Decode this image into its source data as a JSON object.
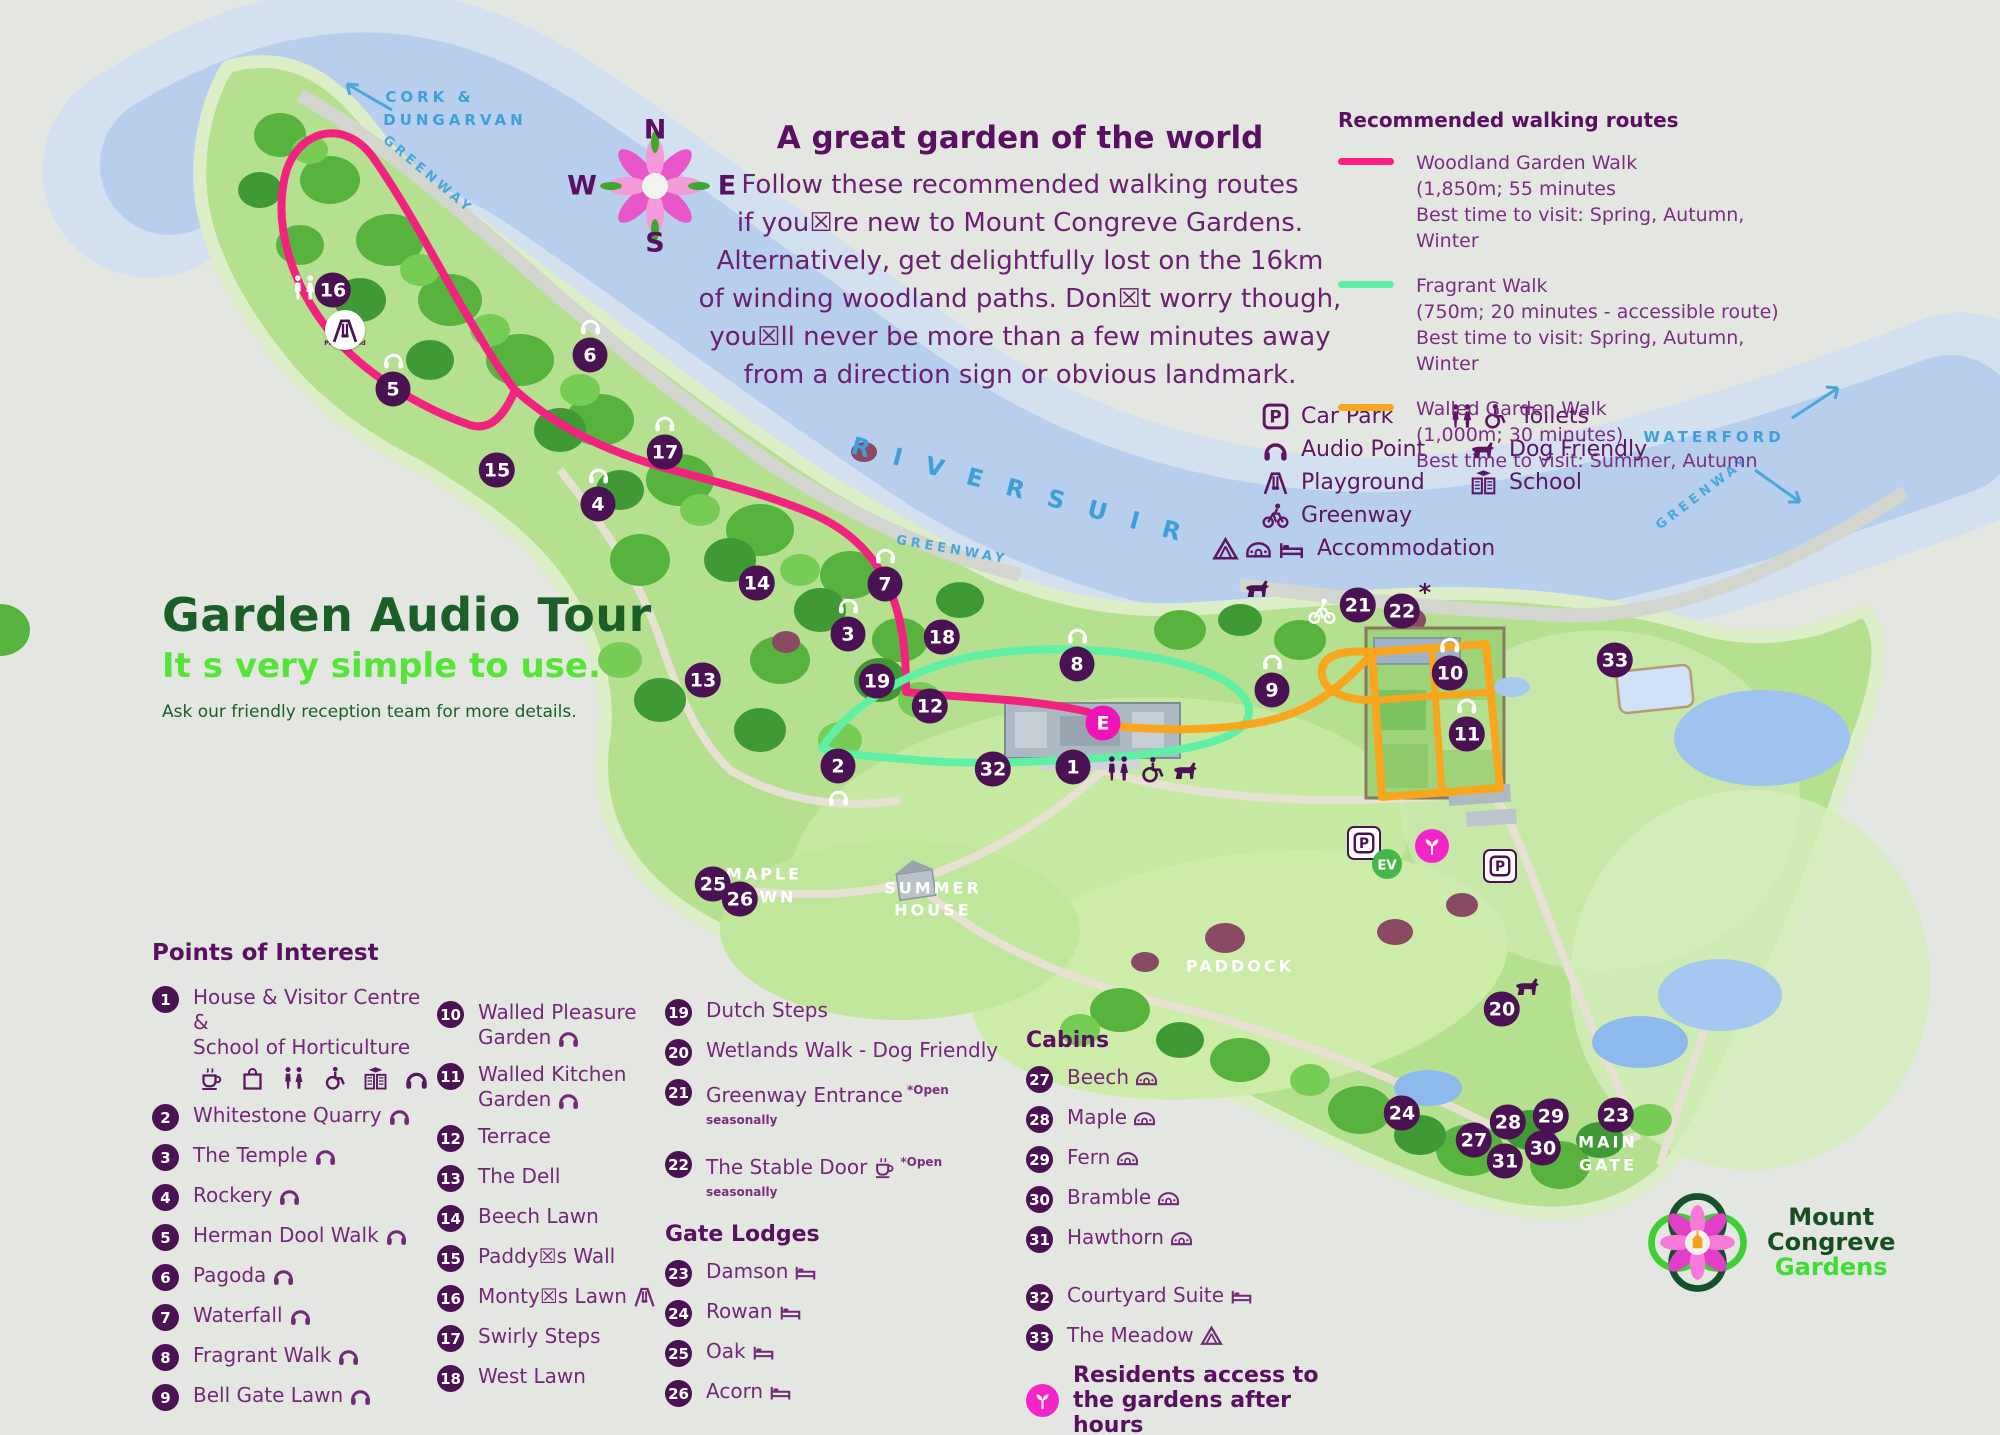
{
  "intro": {
    "title": "A great garden of the world",
    "lines": [
      "Follow these recommended walking routes",
      "if you☒re new to Mount Congreve Gardens.",
      "Alternatively, get delightfully lost on the 16km",
      "of winding woodland paths. Don☒t worry though,",
      "you☒ll never be more than a few minutes away",
      "from a direction sign or obvious landmark."
    ]
  },
  "routes": {
    "heading": "Recommended walking routes",
    "items": [
      {
        "name": "Woodland Garden Walk",
        "detail": "(1,850m; 55 minutes",
        "best": "Best time to visit: Spring, Autumn, Winter",
        "color": "#ff1f7e"
      },
      {
        "name": "Fragrant Walk",
        "detail": "(750m; 20 minutes - accessible route)",
        "best": "Best time to visit: Spring, Autumn, Winter",
        "color": "#5df0a5"
      },
      {
        "name": "Walled Garden Walk",
        "detail": "(1,000m; 30 minutes)",
        "best": "Best time to visit: Summer, Autumn",
        "color": "#f9a61f"
      }
    ]
  },
  "legend": {
    "left": [
      {
        "icon": "carpark",
        "label": "Car Park"
      },
      {
        "icon": "headphones",
        "label": "Audio Point"
      },
      {
        "icon": "playground",
        "label": "Playground"
      },
      {
        "icon": "bike",
        "label": "Greenway"
      },
      {
        "icon": "accommodation",
        "label": "Accommodation"
      }
    ],
    "right": [
      {
        "icon": "toilets",
        "label": "Toilets"
      },
      {
        "icon": "dog",
        "label": "Dog Friendly"
      },
      {
        "icon": "school",
        "label": "School"
      }
    ]
  },
  "audio_tour": {
    "title": "Garden Audio Tour",
    "subtitle": "It s very simple to use.",
    "note": "Ask our friendly reception team for more details."
  },
  "poi": {
    "heading": "Points of Interest",
    "item1": {
      "num": "1",
      "line1": "House & Visitor Centre &",
      "line2": "School of Horticulture"
    },
    "col1": [
      {
        "num": "2",
        "label": "Whitestone Quarry",
        "hp": true
      },
      {
        "num": "3",
        "label": "The Temple",
        "hp": true
      },
      {
        "num": "4",
        "label": "Rockery",
        "hp": true
      },
      {
        "num": "5",
        "label": "Herman Dool Walk",
        "hp": true
      },
      {
        "num": "6",
        "label": "Pagoda",
        "hp": true
      },
      {
        "num": "7",
        "label": "Waterfall",
        "hp": true
      },
      {
        "num": "8",
        "label": "Fragrant Walk",
        "hp": true
      },
      {
        "num": "9",
        "label": "Bell Gate Lawn",
        "hp": true
      }
    ],
    "col2": [
      {
        "num": "10",
        "label": "Walled Pleasure Garden",
        "hp": true
      },
      {
        "num": "11",
        "label": "Walled Kitchen Garden",
        "hp": true
      },
      {
        "num": "12",
        "label": "Terrace"
      },
      {
        "num": "13",
        "label": "The Dell"
      },
      {
        "num": "14",
        "label": "Beech Lawn"
      },
      {
        "num": "15",
        "label": "Paddy☒s Wall"
      },
      {
        "num": "16",
        "label": "Monty☒s Lawn",
        "pg": true
      },
      {
        "num": "17",
        "label": "Swirly Steps"
      },
      {
        "num": "18",
        "label": "West Lawn"
      }
    ],
    "col3": [
      {
        "num": "19",
        "label": "Dutch Steps"
      },
      {
        "num": "20",
        "label": "Wetlands Walk - Dog Friendly"
      },
      {
        "num": "21",
        "label": "Greenway Entrance",
        "open": "*Open seasonally"
      },
      {
        "num": "22",
        "label": "The Stable Door",
        "coffee": true,
        "open": "*Open seasonally"
      }
    ]
  },
  "gate_lodges": {
    "heading": "Gate Lodges",
    "items": [
      {
        "num": "23",
        "label": "Damson",
        "bed": true
      },
      {
        "num": "24",
        "label": "Rowan",
        "bed": true
      },
      {
        "num": "25",
        "label": "Oak",
        "bed": true
      },
      {
        "num": "26",
        "label": "Acorn",
        "bed": true
      }
    ]
  },
  "cabins": {
    "heading": "Cabins",
    "items": [
      {
        "num": "27",
        "label": "Beech",
        "pod": true
      },
      {
        "num": "28",
        "label": "Maple",
        "pod": true
      },
      {
        "num": "29",
        "label": "Fern",
        "pod": true
      },
      {
        "num": "30",
        "label": "Bramble",
        "pod": true
      },
      {
        "num": "31",
        "label": "Hawthorn",
        "pod": true
      }
    ],
    "extras": [
      {
        "num": "32",
        "label": "Courtyard Suite",
        "bed": true
      },
      {
        "num": "33",
        "label": "The Meadow",
        "tent": true
      }
    ]
  },
  "access_notes": {
    "residents": "Residents access to the gardens after hours",
    "exit_letter": "E",
    "exit": "Garden Exit"
  },
  "logo": {
    "line1": "Mount",
    "line2": "Congreve",
    "line3": "Gardens"
  },
  "map": {
    "labels": [
      {
        "text": "CORK &",
        "x": 430,
        "y": 97,
        "cls": "blue"
      },
      {
        "text": "DUNGARVAN",
        "x": 455,
        "y": 120,
        "cls": "blue"
      },
      {
        "text": "WATERFORD",
        "x": 1714,
        "y": 437,
        "cls": "blue"
      },
      {
        "text": "GREENWAY",
        "x": 428,
        "y": 175,
        "rot": 40,
        "cls": "blue-sm"
      },
      {
        "text": "GREENWAY",
        "x": 952,
        "y": 550,
        "rot": 10,
        "cls": "blue-sm"
      },
      {
        "text": "GREENWAY",
        "x": 1703,
        "y": 493,
        "rot": -37,
        "cls": "blue-sm"
      },
      {
        "text": "R I V E R   S U I R",
        "x": 1020,
        "y": 490,
        "rot": 15,
        "cls": "river",
        "size": 24,
        "ls": 8
      },
      {
        "text": "MAPLE",
        "x": 764,
        "y": 874,
        "cls": "white"
      },
      {
        "text": "LAWN",
        "x": 764,
        "y": 897,
        "cls": "white"
      },
      {
        "text": "SUMMER",
        "x": 933,
        "y": 888,
        "cls": "white"
      },
      {
        "text": "HOUSE",
        "x": 933,
        "y": 910,
        "cls": "white"
      },
      {
        "text": "PADDOCK",
        "x": 1240,
        "y": 966,
        "cls": "white"
      },
      {
        "text": "MAIN",
        "x": 1608,
        "y": 1142,
        "cls": "white"
      },
      {
        "text": "GATE",
        "x": 1608,
        "y": 1165,
        "cls": "white"
      },
      {
        "text": "Playground",
        "x": 345,
        "y": 343,
        "cls": "micro"
      },
      {
        "text": "N",
        "x": 655,
        "y": 130,
        "cls": "compass"
      },
      {
        "text": "W",
        "x": 582,
        "y": 186,
        "cls": "compass"
      },
      {
        "text": "E",
        "x": 727,
        "y": 186,
        "cls": "compass"
      },
      {
        "text": "S",
        "x": 655,
        "y": 243,
        "cls": "compass"
      }
    ],
    "markers": [
      {
        "num": "16",
        "x": 333,
        "y": 290
      },
      {
        "num": "5",
        "x": 393,
        "y": 377,
        "hp_above": true
      },
      {
        "num": "6",
        "x": 590,
        "y": 343,
        "hp_above": true
      },
      {
        "num": "15",
        "x": 497,
        "y": 470
      },
      {
        "num": "17",
        "x": 665,
        "y": 440,
        "hp_above": true
      },
      {
        "num": "4",
        "x": 598,
        "y": 492,
        "hp_above": true
      },
      {
        "num": "14",
        "x": 757,
        "y": 583
      },
      {
        "num": "7",
        "x": 885,
        "y": 572,
        "hp_above": true
      },
      {
        "num": "3",
        "x": 848,
        "y": 622,
        "hp_above": true
      },
      {
        "num": "18",
        "x": 942,
        "y": 637
      },
      {
        "num": "13",
        "x": 703,
        "y": 680
      },
      {
        "num": "19",
        "x": 877,
        "y": 681
      },
      {
        "num": "8",
        "x": 1077,
        "y": 652,
        "hp_above": true
      },
      {
        "num": "9",
        "x": 1272,
        "y": 678,
        "hp_above": true
      },
      {
        "num": "21",
        "x": 1358,
        "y": 605
      },
      {
        "num": "22",
        "x": 1402,
        "y": 611,
        "star": true
      },
      {
        "num": "10",
        "x": 1450,
        "y": 661,
        "hp_above": true
      },
      {
        "num": "11",
        "x": 1467,
        "y": 722,
        "hp_above": true
      },
      {
        "num": "33",
        "x": 1615,
        "y": 660
      },
      {
        "num": "E",
        "x": 1103,
        "y": 723,
        "cls": "pink"
      },
      {
        "num": "1",
        "x": 1073,
        "y": 767
      },
      {
        "num": "32",
        "x": 993,
        "y": 769
      },
      {
        "num": "12",
        "x": 930,
        "y": 706
      },
      {
        "num": "2",
        "x": 838,
        "y": 778,
        "hp_below": true
      },
      {
        "num": "25",
        "x": 713,
        "y": 884
      },
      {
        "num": "26",
        "x": 740,
        "y": 899
      },
      {
        "num": "20",
        "x": 1502,
        "y": 1009
      },
      {
        "num": "24",
        "x": 1402,
        "y": 1113
      },
      {
        "num": "27",
        "x": 1474,
        "y": 1140
      },
      {
        "num": "28",
        "x": 1508,
        "y": 1122
      },
      {
        "num": "29",
        "x": 1551,
        "y": 1116
      },
      {
        "num": "30",
        "x": 1543,
        "y": 1148
      },
      {
        "num": "31",
        "x": 1505,
        "y": 1161
      },
      {
        "num": "23",
        "x": 1616,
        "y": 1115
      }
    ],
    "icons": [
      {
        "icon": "toilets",
        "x": 304,
        "y": 288,
        "cls": "wh"
      },
      {
        "icon": "playground",
        "x": 345,
        "y": 330,
        "cls": "roundbadge"
      },
      {
        "icon": "dog",
        "x": 1258,
        "y": 588,
        "cls": "dk"
      },
      {
        "icon": "bike",
        "x": 1322,
        "y": 611,
        "cls": "wh"
      },
      {
        "icon": "toilets",
        "x": 1118,
        "y": 769,
        "cls": "dk"
      },
      {
        "icon": "wheelchair",
        "x": 1152,
        "y": 770,
        "cls": "dk"
      },
      {
        "icon": "dog",
        "x": 1186,
        "y": 770,
        "cls": "dk"
      },
      {
        "icon": "carpark",
        "x": 1364,
        "y": 843,
        "cls": "badge"
      },
      {
        "icon": "ev",
        "x": 1387,
        "y": 864,
        "cls": "evpin",
        "glyph": "EV"
      },
      {
        "icon": "sprout",
        "x": 1432,
        "y": 846,
        "cls": "pinkc"
      },
      {
        "icon": "carpark",
        "x": 1500,
        "y": 866,
        "cls": "badge"
      },
      {
        "icon": "dog",
        "x": 1528,
        "y": 986,
        "cls": "dk"
      }
    ]
  }
}
